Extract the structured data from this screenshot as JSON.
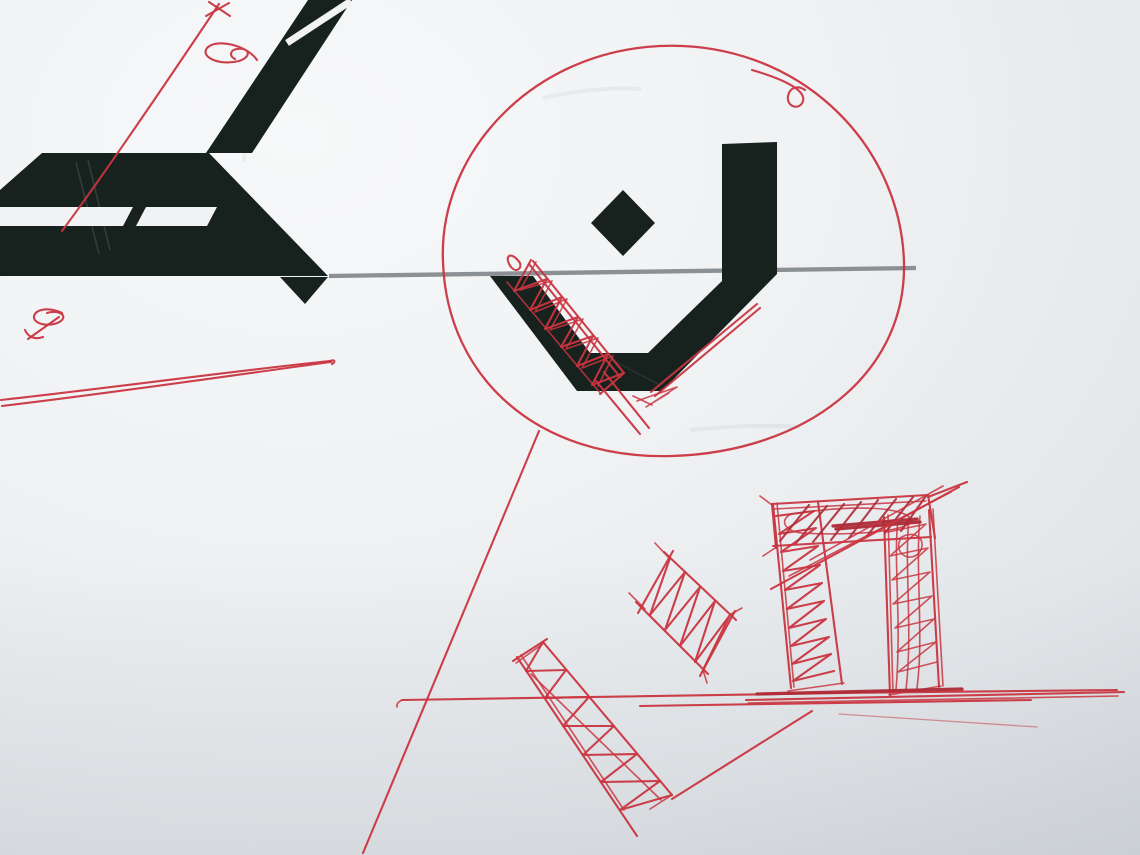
{
  "meta": {
    "type": "photograph",
    "subject": "Photo of a sheet of paper bearing large printed black calligraphic shapes with red ballpoint-pen design sketches and annotations drawn over them",
    "width_px": 1140,
    "height_px": 855
  },
  "colors": {
    "paper-light": "#f6f7f8",
    "paper-mid": "#edeff1",
    "paper-dark": "#d6dade",
    "paper-cut": "#f1f2f4",
    "ink-black": "#17211e",
    "pen-red": "#c93540",
    "pen-red-dark": "#ad2a36",
    "rule-gray": "#8a9094"
  },
  "scene": {
    "elements": [
      {
        "name": "printed-diagonal-stroke-top-left",
        "description": "thick black diagonal printed stroke running from the top edge down-left, sliced near its top by a thin white gap"
      },
      {
        "name": "printed-horizontal-bar",
        "description": "large black printed bar upper-left with two white slit cutouts and a 45-degree right end"
      },
      {
        "name": "printed-tail-wedge",
        "description": "small black wedge pointing down-right below the bar's right end"
      },
      {
        "name": "printed-bowl-glyph",
        "description": "black printed bowl/V-shaped glyph with tall vertical stem on the right, centre of image"
      },
      {
        "name": "printed-diamond-dot",
        "description": "black printed diamond above the bowl glyph"
      },
      {
        "name": "gray-rule-line",
        "description": "thin straight gray printed line crossing the page horizontally at the bowl rim"
      },
      {
        "name": "red-circle-annotation",
        "description": "large freehand red pen circle drawn around the bowl glyph, with a small curl where the stroke ends at top right"
      },
      {
        "name": "red-hatch-left-arm",
        "description": "dense red zigzag hatching along the left arm of the bowl, with two long overshoot strokes below"
      },
      {
        "name": "red-line-right-arm",
        "description": "doubled red line along the right inner slope of the bowl with small scribbles at its lower end"
      },
      {
        "name": "red-arrow-line-top-left",
        "description": "long red line rising across the printed bar toward the top edge, ending in a small cross/arrow scribble"
      },
      {
        "name": "red-ribbon-scribble",
        "description": "looping red scribble right of the diagonal stroke"
      },
      {
        "name": "red-knot-scribble",
        "description": "small looped red scribble with tail, lower left of the printed bar"
      },
      {
        "name": "red-double-baseline",
        "description": "two nearly merged long red lines rising gently from the left edge, below the printed bar"
      },
      {
        "name": "red-descending-line",
        "description": "long straight red line from the circle's lower left down to the bottom edge"
      },
      {
        "name": "red-arch-sketch",
        "description": "red sketch of a doorway/arch: two hatched columns and a heavily hatched lintel with long overshoot strokes"
      },
      {
        "name": "red-hatched-parallelogram",
        "description": "small tilted red rectangle filled with zigzag hatching"
      },
      {
        "name": "red-hatched-strip",
        "description": "long tilted red strip filled with spring-like zigzag hatching, running to the lower middle"
      },
      {
        "name": "red-ground-lines",
        "description": "cluster of long nearly horizontal red lines forming a ground/datum under the sketches"
      },
      {
        "name": "red-triangle-edge",
        "description": "red diagonal joining the strip's lower end up to the ground lines"
      },
      {
        "name": "faint-pencil-line",
        "description": "very light thin line sloping down-right near the ground lines"
      }
    ]
  }
}
